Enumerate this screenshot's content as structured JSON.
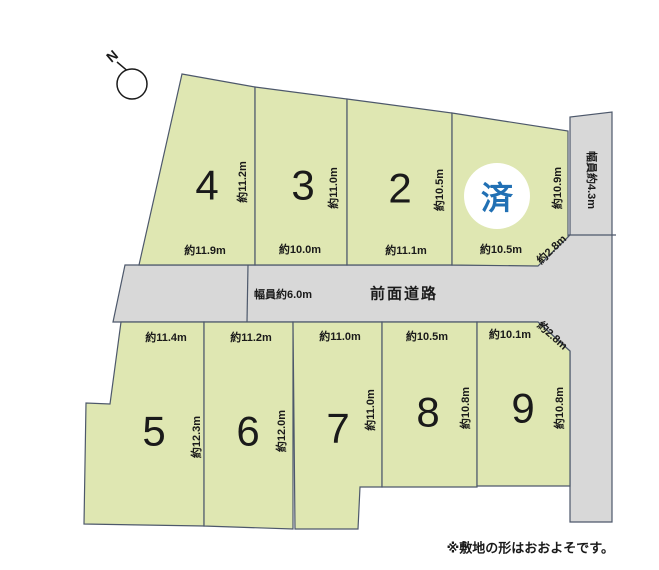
{
  "note": "※敷地の形はおおよそです。",
  "compass": {
    "label": "N"
  },
  "roads": {
    "front": {
      "name": "前面道路",
      "width": "幅員約6.0m"
    },
    "side": {
      "width": "幅員約4.3m"
    }
  },
  "top_plots": [
    {
      "number": "4",
      "side_length": "約11.2m",
      "frontage": "約11.9m"
    },
    {
      "number": "3",
      "side_length": "約11.0m",
      "frontage": "約10.0m"
    },
    {
      "number": "2",
      "side_length": "約10.5m",
      "frontage": "約11.1m"
    },
    {
      "number": "済",
      "status": "sold",
      "side_length": "約10.9m",
      "frontage": "約10.5m",
      "corner": "約2.8m"
    }
  ],
  "bottom_plots": [
    {
      "number": "5",
      "frontage": "約11.4m",
      "side_length": "約12.3m"
    },
    {
      "number": "6",
      "frontage": "約11.2m",
      "side_length": "約12.0m"
    },
    {
      "number": "7",
      "frontage": "約11.0m",
      "side_length": "約11.0m"
    },
    {
      "number": "8",
      "frontage": "約10.5m",
      "side_length": "約10.8m"
    },
    {
      "number": "9",
      "frontage": "約10.1m",
      "side_length": "約10.8m",
      "corner": "約2.8m"
    }
  ],
  "colors": {
    "plot_fill": "#dfe7b2",
    "road_fill": "#d8d8d8",
    "line": "#4d586b",
    "sold_text": "#2170b4",
    "number_text": "#1a1a1a"
  }
}
